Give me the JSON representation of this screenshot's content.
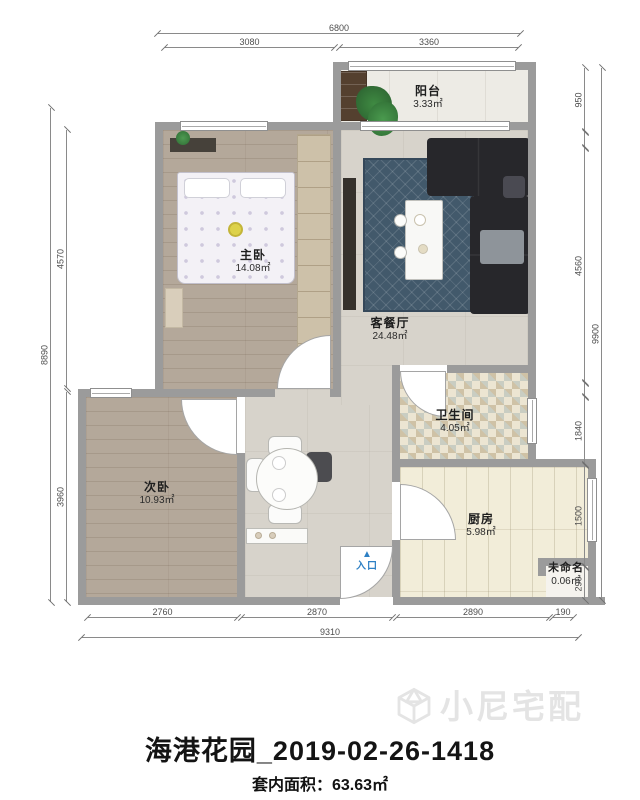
{
  "plan_title": "海港花园_2019-02-26-1418",
  "area_summary": {
    "label": "套内面积：",
    "value": "63.63㎡"
  },
  "watermark": {
    "brand": "小尼宅配"
  },
  "rooms": {
    "master": {
      "name": "主卧",
      "area": "14.08㎡"
    },
    "living": {
      "name": "客餐厅",
      "area": "24.48㎡"
    },
    "balcony": {
      "name": "阳台",
      "area": "3.33㎡"
    },
    "bathroom": {
      "name": "卫生间",
      "area": "4.05㎡"
    },
    "second": {
      "name": "次卧",
      "area": "10.93㎡"
    },
    "kitchen": {
      "name": "厨房",
      "area": "5.98㎡"
    },
    "unnamed": {
      "name": "未命名",
      "area": "0.06㎡"
    }
  },
  "entry": {
    "arrow": "▲",
    "label": "入口"
  },
  "dimensions": {
    "top": {
      "total": "6800",
      "seg1": "3080",
      "seg2": "3360"
    },
    "bottom": {
      "total": "9310",
      "seg1": "2760",
      "seg2": "2870",
      "seg3": "2890",
      "seg4": "190"
    },
    "left": {
      "total": "8890",
      "seg1": "4570",
      "seg2": "3960"
    },
    "right": {
      "total": "9900",
      "seg1": "950",
      "seg2": "4560",
      "seg3": "1840",
      "seg4": "1500",
      "seg5": "290"
    }
  },
  "colors": {
    "wall": "#9b9b9b",
    "entry_accent": "#2e80c4",
    "rug": "#42596b",
    "sofa": "#27272b"
  }
}
